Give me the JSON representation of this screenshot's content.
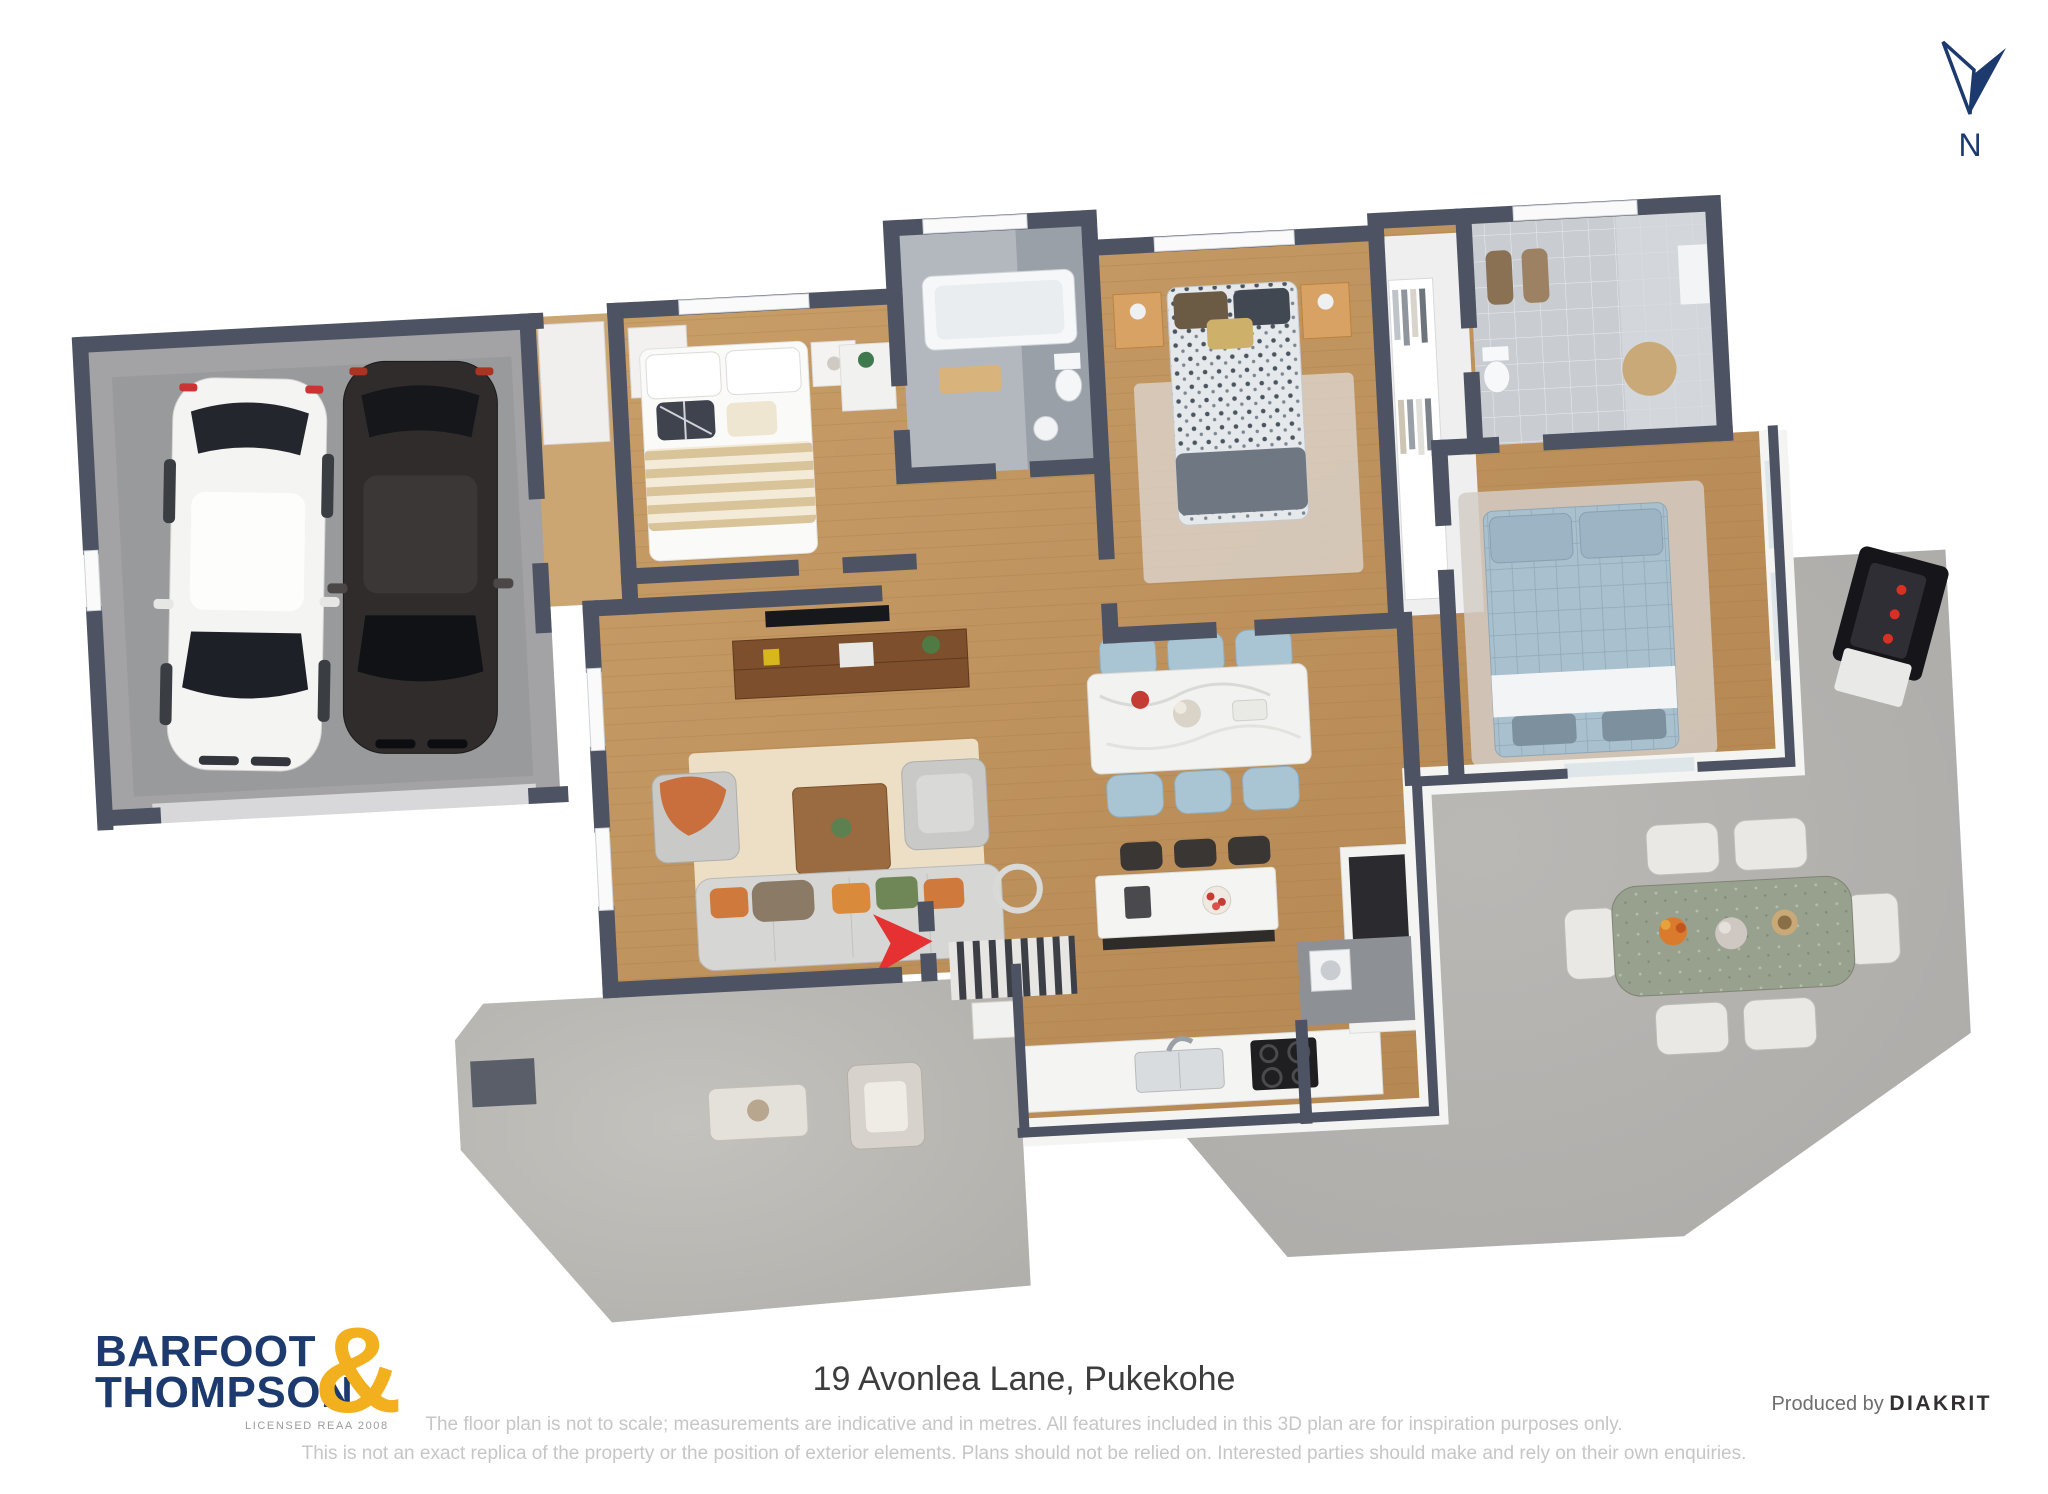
{
  "north_indicator": {
    "label": "N",
    "color": "#1c3a6d"
  },
  "plan": {
    "rooms": [
      "garage",
      "bedroom-1",
      "bathroom",
      "hallway",
      "bedroom-2",
      "walk-in-wardrobe",
      "ensuite-bathroom",
      "master-bedroom",
      "living-room",
      "dining-area",
      "kitchen",
      "laundry",
      "entry",
      "front-porch",
      "outdoor-patio"
    ],
    "colors": {
      "wall": "#4d5363",
      "wood_floor": "#c2985f",
      "garage_floor": "#a3a3a5",
      "patio_floor": "#aeadab",
      "porch_floor": "#b9b7b3",
      "tile_floor": "#b3b8bf",
      "rug": "#d9d0c7",
      "entry_arrow": "#e53131",
      "dining_chairs": "#a9c4d2",
      "master_bed": "#a9c0ce"
    }
  },
  "footer": {
    "logo_line1": "BARFOOT",
    "logo_line2": "THOMPSON",
    "logo_ampersand": "&",
    "logo_sub": "LICENSED REAA 2008",
    "address": "19 Avonlea Lane, Pukekohe",
    "disclaimer_line1": "The floor plan is not to scale; measurements are indicative and in metres. All features included in this 3D plan are for inspiration purposes only.",
    "disclaimer_line2": "This is not an exact replica of the property or the position of exterior elements. Plans should not be relied on. Interested parties should make and rely on their own enquiries.",
    "credit_prefix": "Produced by",
    "credit_brand": "DIAKRIT"
  }
}
